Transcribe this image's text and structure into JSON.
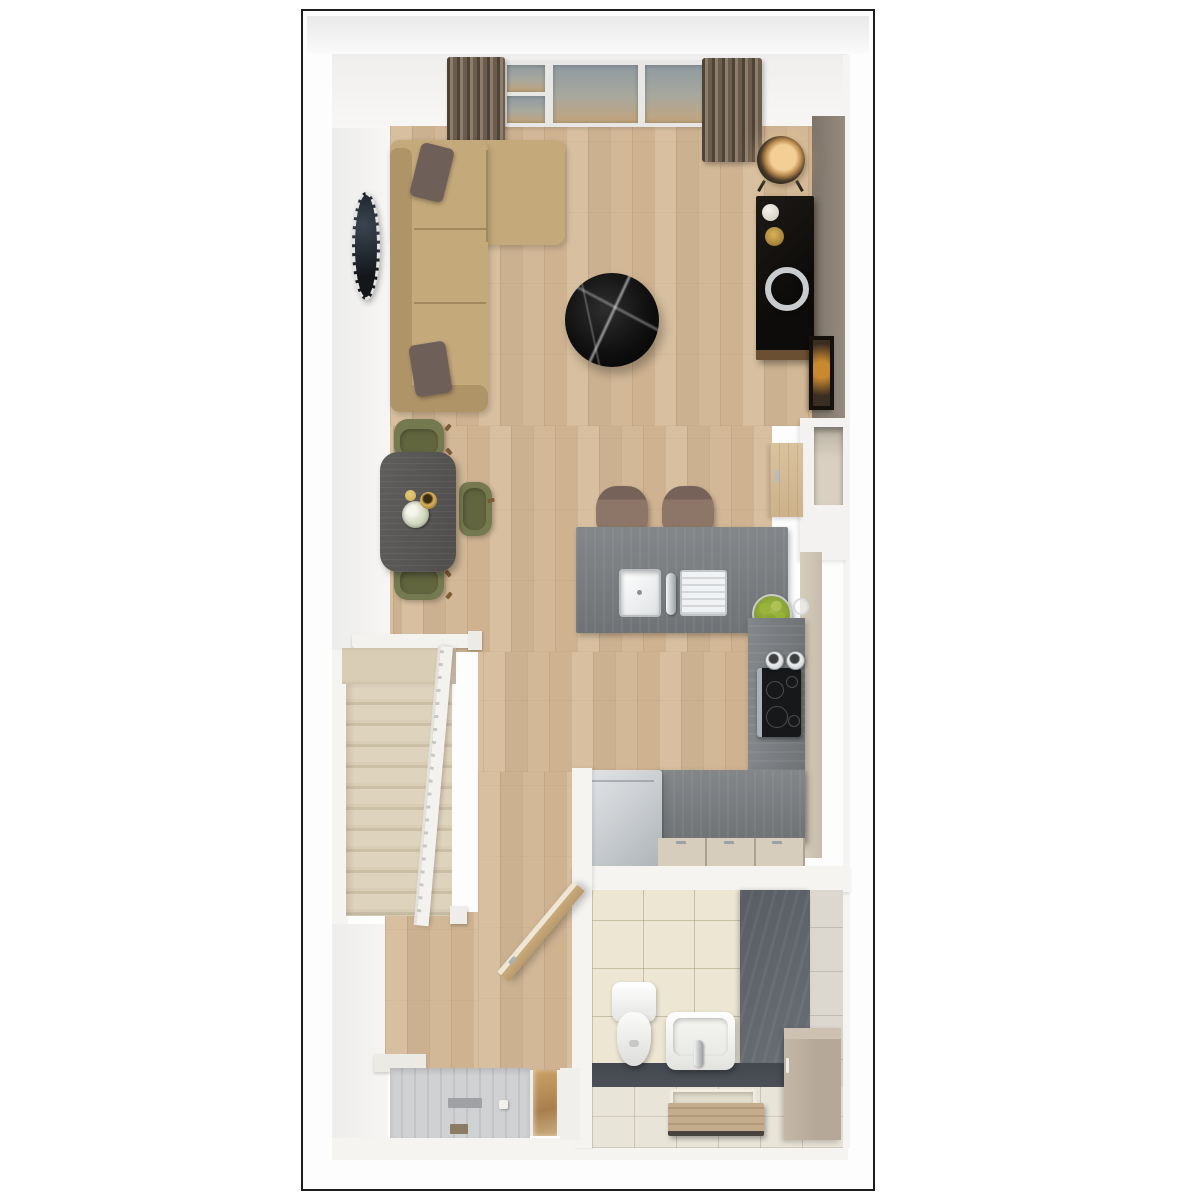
{
  "palette": {
    "frame_border": "#1d1d1d",
    "wall_white": "#f5f4f1",
    "taupe_dark": "#7e7469",
    "taupe_light": "#948a7e",
    "niche_beige": "#d9d0c1",
    "cabinet_beige": "#d6cdbc",
    "wood_a": "#d7bf9f",
    "wood_b": "#cbb190",
    "sofa": "#c4a97b",
    "sofa_dark": "#af9468",
    "pillow": "#6e5f59",
    "marble": "#101010",
    "lamp_glow": "#f3cf96",
    "chrome": "#c9ccce",
    "art_amber": "#c98a2f",
    "table_wood": "#5f5e5c",
    "chair_olive": "#75794f",
    "chair_olive_dark": "#62663f",
    "counter_a": "#83878a",
    "counter_b": "#6f7376",
    "stool": "#8d7668",
    "stool_dark": "#77625a",
    "apple": "#9ab339",
    "appliance": "#ccd0d3",
    "carpet": "#d9cdb5",
    "carpet_dark": "#cbbfa6",
    "rail_white": "#f3f2ef",
    "mat_a": "#d0d1d3",
    "mat_b": "#c2c3c5",
    "mat_wood": "#c3ad8c",
    "glass_top": "#8f9aa0",
    "glass_bottom": "#c2a47c",
    "curtain_a": "#4e4337",
    "curtain_b": "#8d7d6c",
    "door_wood": "#c8aa7d",
    "door_edge": "#efe7d6",
    "tile_wall": "#ece6d3",
    "tile_floor": "#e9e4d8",
    "slate": "#585d63",
    "slate_floor": "#4c5157",
    "vanity": "#b5a898"
  },
  "floorplan": {
    "view": "top-down 3d render",
    "rooms": [
      {
        "id": "living-room",
        "items": [
          "corner-sofa",
          "cushions",
          "coffee-table",
          "media-console",
          "floor-lamp",
          "wall-mirror",
          "leaning-picture",
          "window",
          "curtains"
        ]
      },
      {
        "id": "dining-area",
        "items": [
          "dining-table",
          "dining-chairs",
          "flower-bowl",
          "gold-cup"
        ]
      },
      {
        "id": "kitchen",
        "items": [
          "island-with-sink",
          "bar-stools",
          "fruit-bowl",
          "induction-hob",
          "pots",
          "worktop",
          "base-cabinets",
          "washing-machine",
          "tall-cabinet"
        ]
      },
      {
        "id": "staircase",
        "items": [
          "carpeted-steps",
          "balustrade",
          "newel-posts"
        ]
      },
      {
        "id": "hallway",
        "items": [
          "open-door",
          "entrance-mat",
          "glazed-side-panel"
        ]
      },
      {
        "id": "bathroom",
        "items": [
          "toilet",
          "washbasin",
          "vanity-unit",
          "duckboard-mat",
          "slate-accent-wall",
          "tiled-walls"
        ]
      }
    ]
  }
}
